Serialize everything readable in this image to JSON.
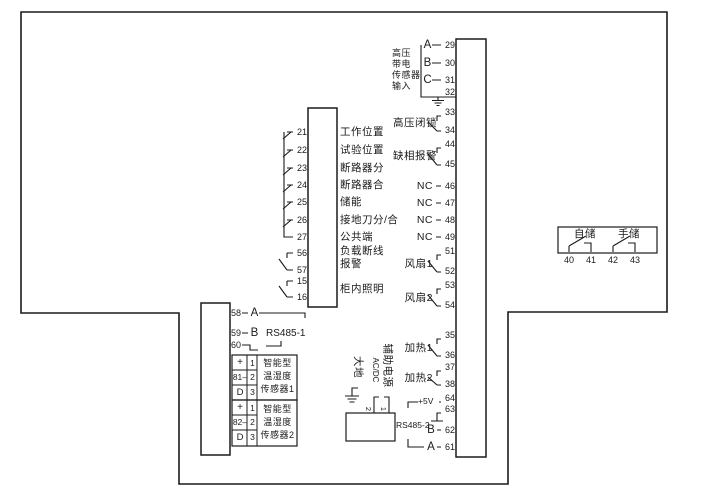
{
  "hv_input": {
    "label_lines": [
      "高压",
      "带电",
      "传感器",
      "输入"
    ],
    "phases": [
      {
        "ph": "A",
        "num": "29"
      },
      {
        "ph": "B",
        "num": "30"
      },
      {
        "ph": "C",
        "num": "31"
      }
    ],
    "ground_num": "32"
  },
  "switch_pairs": [
    {
      "label": "高压闭锁",
      "n1": "33",
      "n2": "34"
    },
    {
      "label": "缺相报警",
      "n1": "44",
      "n2": "45"
    },
    {
      "label": "风扇1",
      "n1": "51",
      "n2": "52"
    },
    {
      "label": "风扇2",
      "n1": "53",
      "n2": "54"
    },
    {
      "label": "加热1",
      "n1": "35",
      "n2": "36"
    },
    {
      "label": "加热2",
      "n1": "37",
      "n2": "38"
    }
  ],
  "nc_rows": [
    {
      "label": "NC",
      "num": "46"
    },
    {
      "label": "NC",
      "num": "47"
    },
    {
      "label": "NC",
      "num": "48"
    },
    {
      "label": "NC",
      "num": "49"
    }
  ],
  "left_io": {
    "rows": [
      {
        "num": "21",
        "label": "工作位置"
      },
      {
        "num": "22",
        "label": "试验位置"
      },
      {
        "num": "23",
        "label": "断路器分"
      },
      {
        "num": "24",
        "label": "断路器合"
      },
      {
        "num": "25",
        "label": "储能"
      },
      {
        "num": "26",
        "label": "接地刀分/合"
      },
      {
        "num": "27",
        "label": "公共端"
      }
    ],
    "pairs": [
      {
        "n1": "56",
        "n2": "57",
        "line1": "负载断线",
        "line2": "报警"
      },
      {
        "n1": "15",
        "n2": "16",
        "line1": "柜内照明",
        "line2": ""
      }
    ]
  },
  "rs485_1": {
    "n58": "58",
    "sigA": "A",
    "n59": "59",
    "sigB": "B",
    "label": "RS485-1",
    "n60": "60"
  },
  "sensors": [
    {
      "sig1": "+",
      "sig2": "81–",
      "sig3": "D",
      "pin1": "1",
      "pin2": "2",
      "pin3": "3",
      "name_lines": [
        "智能型",
        "温湿度",
        "传感器1"
      ]
    },
    {
      "sig1": "+",
      "sig2": "82–",
      "sig3": "D",
      "pin1": "1",
      "pin2": "2",
      "pin3": "3",
      "name_lines": [
        "智能型",
        "温湿度",
        "传感器2"
      ]
    }
  ],
  "power": {
    "earth": "大地",
    "acdc": "AC/DC",
    "aux": "辅助电源",
    "t2": "2",
    "t1": "1"
  },
  "rs485_2": {
    "v5": "+5V",
    "n64": "64",
    "n63": "63",
    "sigB": "B",
    "n62": "62",
    "sigA": "A",
    "n61": "61",
    "label": "RS485-2"
  },
  "storage": {
    "auto": "自储",
    "manual": "手储",
    "t": [
      "40",
      "41",
      "42",
      "43"
    ]
  }
}
